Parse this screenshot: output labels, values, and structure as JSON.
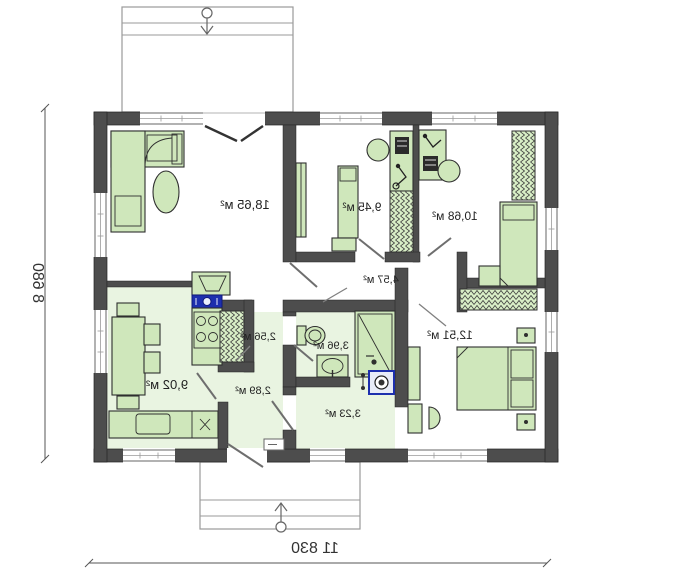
{
  "plan": {
    "type": "house-floor-plan-mirrored",
    "overall_width_label": "11 830",
    "overall_depth_label": "8 680",
    "rooms": [
      {
        "name": "living-room",
        "area": "18,65 м²"
      },
      {
        "name": "bedroom-1",
        "area": "9,45 м²"
      },
      {
        "name": "bedroom-2",
        "area": "10,68 м²"
      },
      {
        "name": "hall",
        "area": "4,57 м²"
      },
      {
        "name": "bedroom-3",
        "area": "12,51 м²"
      },
      {
        "name": "pantry",
        "area": "2,56 м²"
      },
      {
        "name": "bathroom",
        "area": "3,96 м²"
      },
      {
        "name": "corridor",
        "area": "2,89 м²"
      },
      {
        "name": "kitchen",
        "area": "9,02 м²"
      },
      {
        "name": "laundry",
        "area": "3,23 м²"
      }
    ],
    "colors": {
      "wall": "#4d4d4d",
      "furniture": "#cfe7bb",
      "wet_floor": "#e9f4e1",
      "plumbing_blue": "#1d2fae",
      "annotation_gray": "#808080"
    }
  }
}
